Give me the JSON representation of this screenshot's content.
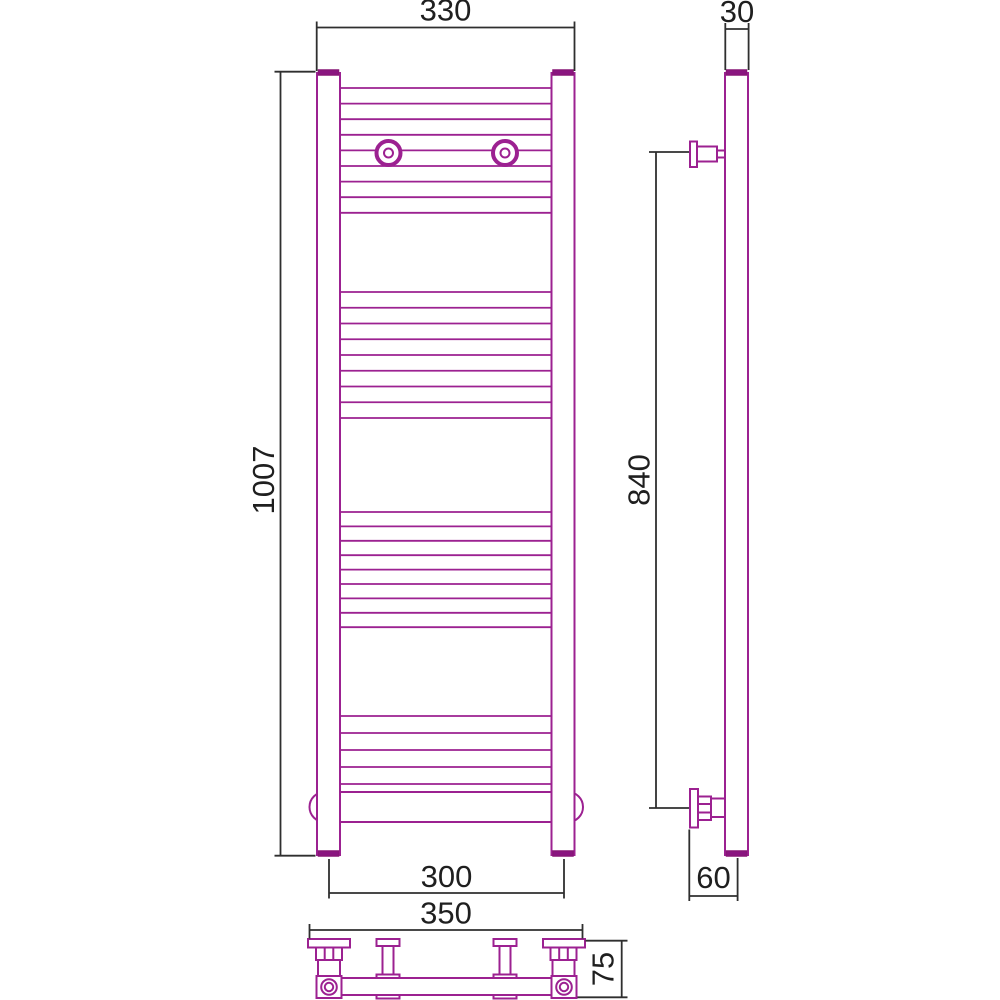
{
  "drawing": {
    "subject": "heated towel rail — two-view dimensional drawing (front and side)",
    "colors": {
      "product_outline": "#9c2191",
      "product_caps": "#8a1580",
      "dimension_lines": "#2f2f2f",
      "background": "#ffffff"
    },
    "front_view": {
      "dim_top_width": "330",
      "dim_height": "1007",
      "dim_bottom_axis_width": "300",
      "dim_bottom_overall_width": "350"
    },
    "side_view": {
      "dim_depth": "30",
      "dim_bracket_span": "840",
      "dim_wall_offset": "60",
      "dim_valve_height": "75"
    }
  }
}
